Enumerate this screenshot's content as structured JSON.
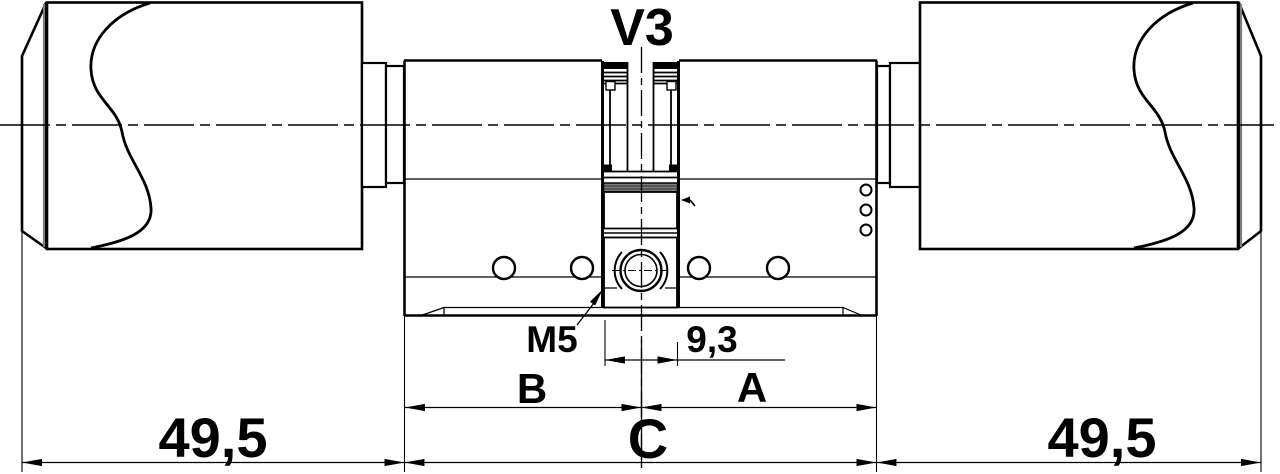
{
  "drawing": {
    "title": "double-thumbturn-locking-cylinder-dimension-drawing",
    "labels": {
      "v3": "V3",
      "m5": "M5",
      "cam": "9,3",
      "b": "B",
      "a": "A",
      "c": "C",
      "knob_left": "49,5",
      "knob_right": "49,5"
    },
    "colors": {
      "line": "#000000",
      "background": "#ffffff",
      "shade": "#7d7d7d"
    }
  }
}
